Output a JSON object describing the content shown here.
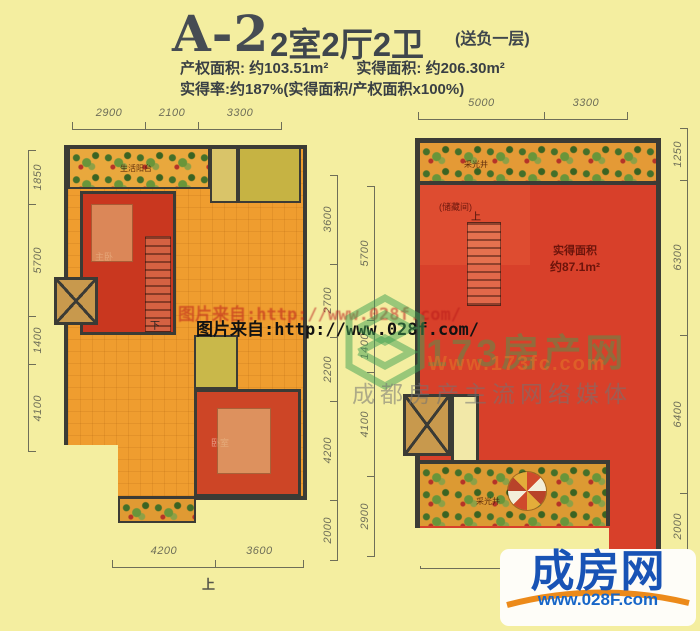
{
  "header": {
    "unit_code": "A-2",
    "layout": "2室2厅2卫",
    "bonus_note": "(送负一层)",
    "property_area_label": "产权面积:",
    "property_area_value": "约103.51m²",
    "actual_area_label": "实得面积:",
    "actual_area_value": "约206.30m²",
    "rate_line": "实得率:约187%(实得面积/产权面积x100%)"
  },
  "floor1": {
    "dims_top": [
      "2900",
      "2100",
      "3300"
    ],
    "dims_left": [
      "1850",
      "5700",
      "1400",
      "4100"
    ],
    "dims_right": [
      "3600",
      "2700",
      "2200",
      "4200",
      "2000"
    ],
    "dims_bottom": [
      "4200",
      "3600"
    ],
    "entry_label": "上",
    "rooms": {
      "balcony_top": "生活阳台",
      "master_bedroom": "主卧",
      "bedroom": "卧室",
      "stairs_down": "下"
    }
  },
  "basement": {
    "dims_top": [
      "5000",
      "3300"
    ],
    "dims_left": [
      "5700",
      "1400",
      "4100",
      "2900"
    ],
    "dims_right": [
      "1250",
      "6300",
      "6400",
      "2000"
    ],
    "dims_bottom": [
      "5500"
    ],
    "rooms": {
      "storage": "(储藏间)",
      "area_label": "实得面积",
      "area_value": "约87.1m²",
      "lightwell_top": "采光井",
      "lightwell_bottom": "采光井",
      "stairs_up": "上"
    }
  },
  "watermark": {
    "image_source_line": "图片来自:http://www.028f.com/",
    "brand_text": "173房产网",
    "brand_url": "Www.173fc.com",
    "brand_slogan": "成都房产主流网络媒体"
  },
  "logo": {
    "name": "成房网",
    "url": "www.028F.com"
  },
  "colors": {
    "background": "#f4eea0",
    "plan_orange": "#ef9d2f",
    "plan_red": "#c9371f",
    "basement_red": "#d8402a",
    "wall": "#3b3b35",
    "logo_blue": "#1853b5",
    "logo_orange": "#ec8a1a",
    "watermark_green": "#3ea052"
  }
}
